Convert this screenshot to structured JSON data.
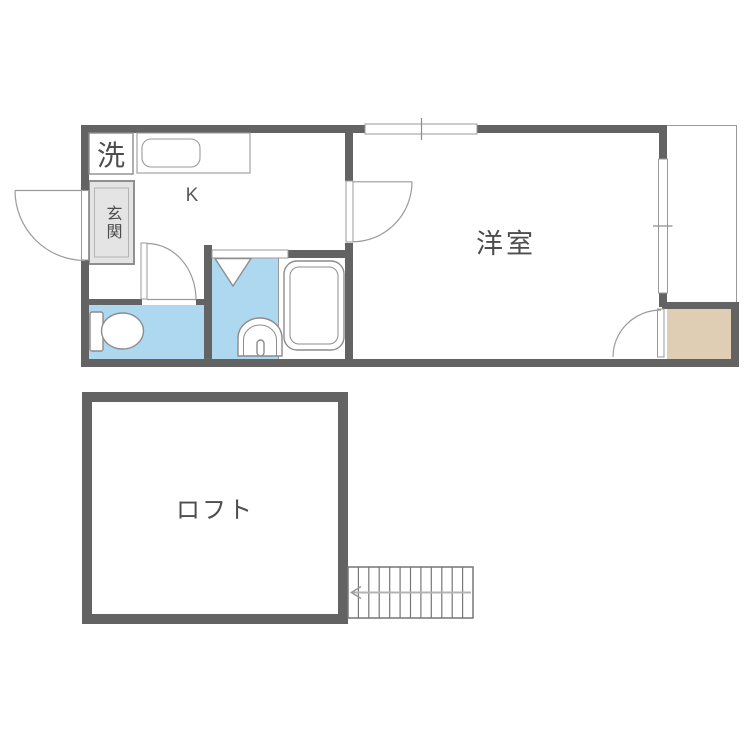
{
  "floorplan": {
    "colors": {
      "wall": "#636363",
      "water_area": "#aed8f0",
      "closet_fill": "#e0ceb4",
      "entrance_fill": "#e4e4e4",
      "outline_dark": "#8c8c8c",
      "outline_light": "#9a9a9a",
      "label_text": "#4d4d4d",
      "stair_arrow": "#b3b3b3",
      "background": "#ffffff"
    },
    "unit": {
      "labels": {
        "washer": "洗",
        "entrance": "玄関",
        "kitchen": "K",
        "western_room": "洋室"
      },
      "fixtures": [
        "washing-machine-space",
        "kitchen-counter",
        "kitchen-sink",
        "entrance-door",
        "kitchen-door",
        "toilet",
        "toilet-door",
        "shower-folding-door",
        "wash-basin",
        "bathtub",
        "sliding-window-top",
        "sliding-window-right",
        "balcony",
        "closet",
        "closet-door"
      ]
    },
    "loft": {
      "labels": {
        "loft": "ロフト"
      },
      "fixtures": [
        "staircase",
        "stair-direction-arrow"
      ]
    }
  }
}
